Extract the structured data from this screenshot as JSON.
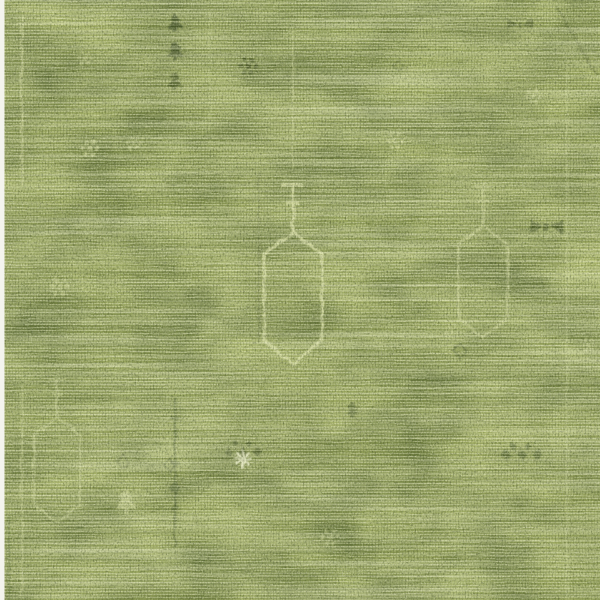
{
  "image": {
    "description": "Close-up photograph of a moss-green distressed hand-knotted wool rug with faded traditional Oushak-style motifs: an elongated hexagonal pendant medallion at center, a smaller pendant medallion at right and lower-left, columns of small dark tree and arrow motifs, scattered rosettes and diamond flower clusters, faint border guard lines near the edges, and strong horizontal weft streaking across the entire weave. A narrow white photo margin runs along the left edge."
  },
  "palette": {
    "base": "#93a05a",
    "mottle_dark": "#5a6a33",
    "mottle_light": "#bec979",
    "weft_light": "#edf0cb",
    "streak_dark": "#4d5d2b",
    "grain_dark": "#323e1b",
    "grain_light": "#f3f4da",
    "motif_light": "#dce2a6",
    "motif_dark": "#3b4b20",
    "motif_cream": "#f0f2d1",
    "photo_margin": "#f4f4ee"
  },
  "motifs": [
    {
      "type": "pendant",
      "x": 293,
      "y": 298,
      "s": 1,
      "color": "motif_light",
      "opacity": 0.8
    },
    {
      "type": "pendant",
      "x": 483,
      "y": 282,
      "s": 0.85,
      "color": "motif_light",
      "opacity": 0.5
    },
    {
      "type": "pendant",
      "x": 57,
      "y": 470,
      "s": 0.8,
      "color": "motif_light",
      "opacity": 0.45
    },
    {
      "type": "vline",
      "x": 293,
      "y": 30,
      "sy": 1.4,
      "color": "motif_light",
      "opacity": 0.35
    },
    {
      "type": "vline",
      "x": 210,
      "y": 15,
      "sy": 1.15,
      "color": "motif_light",
      "opacity": 0.22
    },
    {
      "type": "vline",
      "x": 22,
      "y": 15,
      "sy": 1.7,
      "color": "motif_light",
      "opacity": 0.5
    },
    {
      "type": "vline",
      "x": 22,
      "y": 385,
      "sy": 2.1,
      "color": "motif_light",
      "opacity": 0.4
    },
    {
      "type": "hline",
      "x": 14,
      "y": 24,
      "sx": 0.8,
      "color": "motif_light",
      "opacity": 0.35
    },
    {
      "type": "vline",
      "x": 567,
      "y": 55,
      "sy": 5.45,
      "color": "motif_light",
      "opacity": 0.28
    },
    {
      "type": "vline",
      "x": 9,
      "y": 515,
      "sy": 0.85,
      "color": "motif_dark",
      "opacity": 0.3
    },
    {
      "type": "diag",
      "x": 556,
      "y": 6,
      "color": "motif_dark",
      "opacity": 0.35
    },
    {
      "type": "vline",
      "x": 259,
      "y": 172,
      "sy": 1.7,
      "color": "motif_dark",
      "opacity": 0.18
    },
    {
      "type": "stem",
      "x": 175,
      "y": 398,
      "sy": 1.5,
      "color": "motif_dark",
      "opacity": 0.5
    },
    {
      "type": "tree",
      "x": 175,
      "y": 22,
      "color": "motif_dark",
      "opacity": 0.85
    },
    {
      "type": "tree",
      "x": 175,
      "y": 50,
      "color": "motif_dark",
      "opacity": 0.8
    },
    {
      "type": "tree",
      "x": 175,
      "y": 80,
      "color": "motif_dark",
      "opacity": 0.7
    },
    {
      "type": "tree",
      "x": 352,
      "y": 409,
      "s": 0.8,
      "color": "motif_dark",
      "opacity": 0.45
    },
    {
      "type": "tree",
      "x": 126,
      "y": 500,
      "s": 1.3,
      "color": "motif_light",
      "opacity": 0.55
    },
    {
      "type": "rosette",
      "x": 248,
      "y": 66,
      "s": 1.2,
      "color": "motif_dark",
      "opacity": 0.7
    },
    {
      "type": "rosette",
      "x": 90,
      "y": 148,
      "s": 1.2,
      "color": "motif_light",
      "opacity": 0.6
    },
    {
      "type": "rosette",
      "x": 133,
      "y": 143,
      "color": "motif_light",
      "opacity": 0.5
    },
    {
      "type": "rosette",
      "x": 395,
      "y": 141,
      "s": 1.1,
      "color": "motif_light",
      "opacity": 0.55
    },
    {
      "type": "rosette",
      "x": 533,
      "y": 96,
      "color": "motif_light",
      "opacity": 0.5
    },
    {
      "type": "rosette",
      "x": 85,
      "y": 58,
      "color": "motif_light",
      "opacity": 0.4
    },
    {
      "type": "rosette",
      "x": 60,
      "y": 287,
      "s": 1.3,
      "color": "motif_light",
      "opacity": 0.4
    },
    {
      "type": "rosette",
      "x": 330,
      "y": 537,
      "s": 1.2,
      "color": "motif_light",
      "opacity": 0.35
    },
    {
      "type": "rosette",
      "x": 589,
      "y": 345,
      "color": "motif_light",
      "opacity": 0.4
    },
    {
      "type": "rosette",
      "x": 452,
      "y": 332,
      "color": "motif_light",
      "opacity": 0.35
    },
    {
      "type": "rosette",
      "x": 427,
      "y": 520,
      "s": 1.1,
      "color": "motif_light",
      "opacity": 0.3
    },
    {
      "type": "band",
      "x": 243,
      "y": 452,
      "s": 1.2,
      "color": "motif_dark",
      "opacity": 0.6
    },
    {
      "type": "snowflake",
      "x": 243,
      "y": 459,
      "color": "motif_cream",
      "opacity": 0.85
    },
    {
      "type": "band",
      "x": 522,
      "y": 455,
      "s": 1.3,
      "color": "motif_dark",
      "opacity": 0.55
    },
    {
      "type": "moth",
      "x": 546,
      "y": 228,
      "s": 1.2,
      "color": "motif_dark",
      "opacity": 0.7
    },
    {
      "type": "moth",
      "x": 520,
      "y": 25,
      "s": 0.9,
      "color": "motif_dark",
      "opacity": 0.5
    },
    {
      "type": "diamond",
      "x": 460,
      "y": 351,
      "color": "motif_dark",
      "opacity": 0.5
    },
    {
      "type": "diamond",
      "x": 123,
      "y": 462,
      "color": "motif_dark",
      "opacity": 0.4
    },
    {
      "type": "diamond",
      "x": 170,
      "y": 465,
      "s": 0.8,
      "color": "motif_dark",
      "opacity": 0.55
    },
    {
      "type": "diamond",
      "x": 398,
      "y": 66,
      "s": 0.8,
      "color": "motif_dark",
      "opacity": 0.35
    }
  ]
}
